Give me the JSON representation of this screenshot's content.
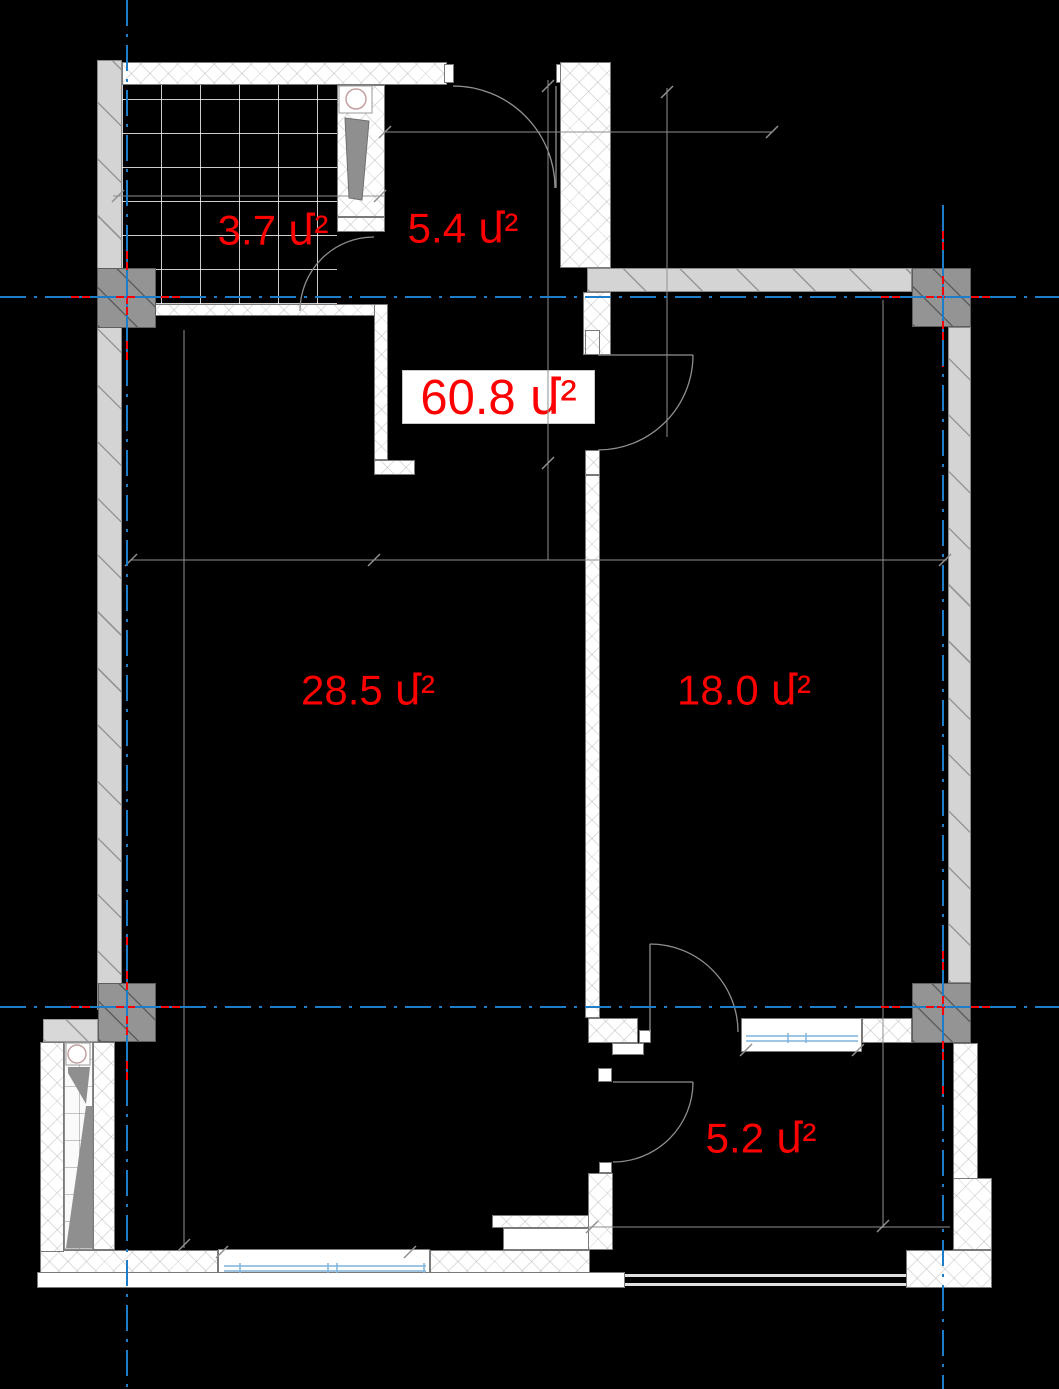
{
  "drawing": {
    "title": "apartment floor plan",
    "labels": {
      "room_top_left": "3.7 մ²",
      "room_top_center": "5.4 մ²",
      "total_area": "60.8 մ²",
      "room_left": "28.5 մ²",
      "room_right": "18.0 մ²",
      "room_bottom_right": "5.2 մ²"
    },
    "colors": {
      "background": "#000000",
      "area_label_red": "#ff0000",
      "axis_blue": "#1d7dc8",
      "glazing_blue": "#7fb4dc",
      "wall_white": "#ffffff",
      "wall_gray": "#d4d4d4",
      "column_gray": "#949494",
      "thin_line_gray": "#8f8f8f"
    }
  }
}
